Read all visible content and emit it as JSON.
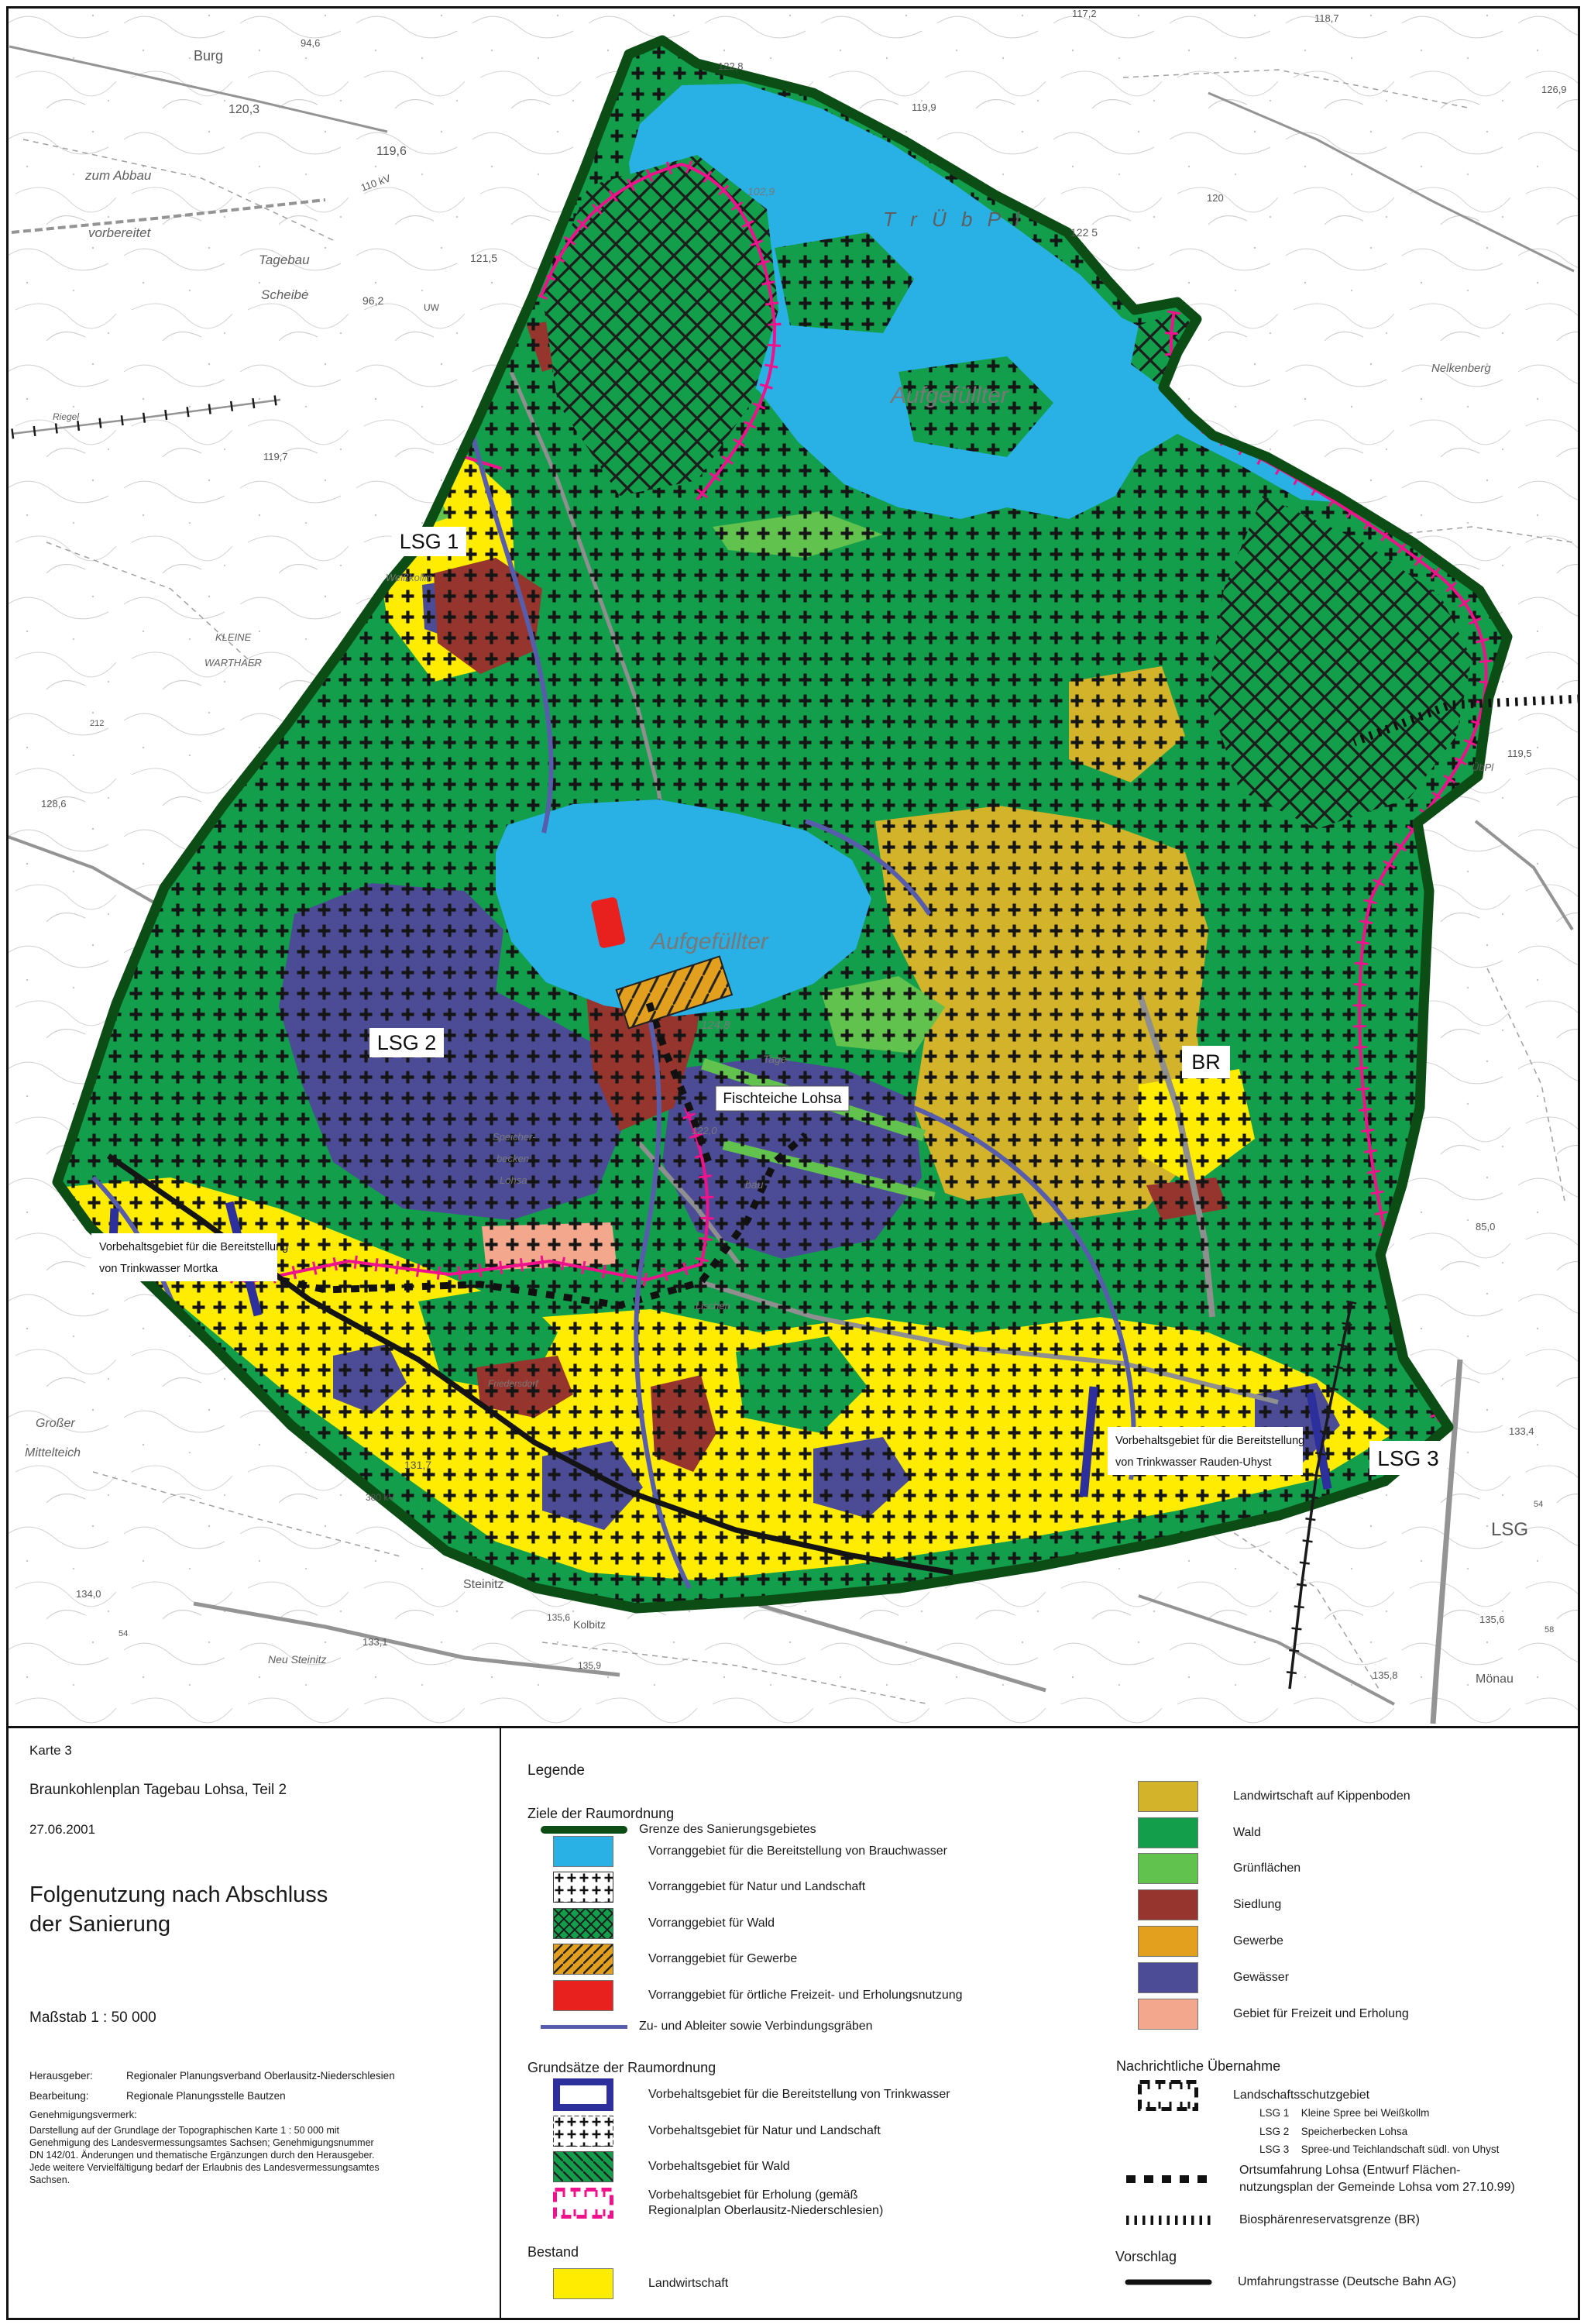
{
  "title_block": {
    "karte": "Karte 3",
    "plan": "Braunkohlenplan Tagebau Lohsa, Teil 2",
    "date": "27.06.2001",
    "title_line1": "Folgenutzung nach Abschluss",
    "title_line2": "der Sanierung",
    "massstab": "Maßstab 1 : 50 000",
    "herausgeber_label": "Herausgeber:",
    "herausgeber": "Regionaler Planungsverband Oberlausitz-Niederschlesien",
    "bearbeitung_label": "Bearbeitung:",
    "bearbeitung": "Regionale Planungsstelle Bautzen",
    "genehmigung_label": "Genehmigungsvermerk:",
    "gen_lines": [
      "Darstellung auf der Grundlage der Topographischen Karte 1 : 50 000 mit",
      "Genehmigung des Landesvermessungsamtes Sachsen; Genehmigungsnummer",
      "DN 142/01. Änderungen und thematische Ergänzungen durch den Herausgeber.",
      "Jede weitere Vervielfältigung bedarf der Erlaubnis des Landesvermessungsamtes",
      "Sachsen."
    ]
  },
  "legend": {
    "heading": "Legende",
    "ziele": {
      "heading": "Ziele der Raumordnung",
      "items": [
        {
          "label": "Grenze des Sanierungsgebietes"
        },
        {
          "label": "Vorranggebiet für die Bereitstellung von Brauchwasser"
        },
        {
          "label": "Vorranggebiet für Natur und Landschaft"
        },
        {
          "label": "Vorranggebiet für Wald"
        },
        {
          "label": "Vorranggebiet für Gewerbe"
        },
        {
          "label": "Vorranggebiet für örtliche Freizeit- und Erholungsnutzung"
        },
        {
          "label": "Zu- und Ableiter sowie Verbindungsgräben"
        }
      ]
    },
    "grundsaetze": {
      "heading": "Grundsätze der Raumordnung",
      "items": [
        {
          "label": "Vorbehaltsgebiet für die Bereitstellung von Trinkwasser"
        },
        {
          "label": "Vorbehaltsgebiet für Natur und Landschaft"
        },
        {
          "label": "Vorbehaltsgebiet für Wald"
        },
        {
          "label_line1": "Vorbehaltsgebiet für Erholung (gemäß",
          "label_line2": "Regionalplan Oberlausitz-Niederschlesien)"
        }
      ]
    },
    "bestand": {
      "heading": "Bestand",
      "items": [
        {
          "label": "Landwirtschaft"
        }
      ]
    },
    "bestand_right": {
      "items": [
        {
          "label": "Landwirtschaft auf Kippenboden"
        },
        {
          "label": "Wald"
        },
        {
          "label": "Grünflächen"
        },
        {
          "label": "Siedlung"
        },
        {
          "label": "Gewerbe"
        },
        {
          "label": "Gewässer"
        },
        {
          "label": "Gebiet für Freizeit und Erholung"
        }
      ]
    },
    "nachrichtlich": {
      "heading": "Nachrichtliche Übernahme",
      "lsg_label": "Landschaftsschutzgebiet",
      "lsg": [
        {
          "code": "LSG 1",
          "desc": "Kleine Spree bei Weißkollm"
        },
        {
          "code": "LSG 2",
          "desc": "Speicherbecken Lohsa"
        },
        {
          "code": "LSG 3",
          "desc": "Spree-und Teichlandschaft südl. von Uhyst"
        }
      ],
      "orts_line1": "Ortsumfahrung Lohsa (Entwurf Flächen-",
      "orts_line2": "nutzungsplan der Gemeinde Lohsa vom 27.10.99)",
      "bio": "Biosphärenreservatsgrenze (BR)"
    },
    "vorschlag": {
      "heading": "Vorschlag",
      "item": "Umfahrungstrasse (Deutsche Bahn AG)"
    }
  },
  "map": {
    "boxes": {
      "lsg1": "LSG 1",
      "lsg2": "LSG 2",
      "lsg3": "LSG 3",
      "br": "BR",
      "fischteiche": "Fischteiche Lohsa",
      "mortka_line1": "Vorbehaltsgebiet für die Bereitstellung",
      "mortka_line2": "von Trinkwasser Mortka",
      "rauden_line1": "Vorbehaltsgebiet für die Bereitstellung",
      "rauden_line2": "von Trinkwasser Rauden-Uhyst"
    },
    "topo": [
      {
        "t": "Burg"
      },
      {
        "t": "94,6"
      },
      {
        "t": "120,3"
      },
      {
        "t": "119,6"
      },
      {
        "t": "110 kV"
      },
      {
        "t": "zum Abbau"
      },
      {
        "t": "vorbereitet"
      },
      {
        "t": "Tagebau"
      },
      {
        "t": "Scheibe"
      },
      {
        "t": "96,2"
      },
      {
        "t": "121,5"
      },
      {
        "t": "UW"
      },
      {
        "t": "117,2"
      },
      {
        "t": "118,7"
      },
      {
        "t": "119,9"
      },
      {
        "t": "122,8"
      },
      {
        "t": "126,9"
      },
      {
        "t": "122 5"
      },
      {
        "t": "120"
      },
      {
        "t": "Nelkenberg"
      },
      {
        "t": "T r Ü b P l"
      },
      {
        "t": "102,9"
      },
      {
        "t": "119,5"
      },
      {
        "t": "ÜbPl"
      },
      {
        "t": "85,0"
      },
      {
        "t": "Großer"
      },
      {
        "t": "Mittelteich"
      },
      {
        "t": "131,7"
      },
      {
        "t": "380 kV"
      },
      {
        "t": "134,0"
      },
      {
        "t": "Steinitz"
      },
      {
        "t": "133,1"
      },
      {
        "t": "Neu Steinitz"
      },
      {
        "t": "Kolbitz"
      },
      {
        "t": "54"
      },
      {
        "t": "133,4"
      },
      {
        "t": "54"
      },
      {
        "t": "LSG"
      },
      {
        "t": "135,6"
      },
      {
        "t": "58"
      },
      {
        "t": "135,8"
      },
      {
        "t": "Mönau"
      },
      {
        "t": "135,6"
      },
      {
        "t": "135,9"
      },
      {
        "t": "128,6"
      },
      {
        "t": "119,7"
      },
      {
        "t": "212"
      },
      {
        "t": "Riegel"
      },
      {
        "t": "KLEINE"
      },
      {
        "t": "WARTHAER"
      },
      {
        "t": "Aufgefüllter"
      },
      {
        "t": "Aufgefüllter"
      },
      {
        "t": "124,8"
      },
      {
        "t": "122,0"
      },
      {
        "t": "Speicher-"
      },
      {
        "t": "becken"
      },
      {
        "t": "Lohsa"
      },
      {
        "t": "Tage-"
      },
      {
        "t": "bau"
      },
      {
        "t": "Weißkollm"
      },
      {
        "t": "Lischen"
      },
      {
        "t": "Friedersdorf"
      }
    ],
    "colors": {
      "brauchwasser": "#29b0e5",
      "wald": "#129e4b",
      "gruenflaechen": "#61c24e",
      "landwirtschaft": "#ffec00",
      "kippenboden": "#d2b32a",
      "siedlung": "#96352e",
      "gewerbe": "#e3a01f",
      "gewaesser": "#4c4c96",
      "freizeit_bestand": "#f3a78c",
      "freizeit_vorrang": "#e8201e",
      "sanierungsgrenze": "#0c4d15",
      "zuableiter": "#585dab",
      "vorbehalt_trinkwasser": "#2c2f9c",
      "vorbehalt_erholung": "#f0128c",
      "schwarz": "#111111"
    }
  }
}
